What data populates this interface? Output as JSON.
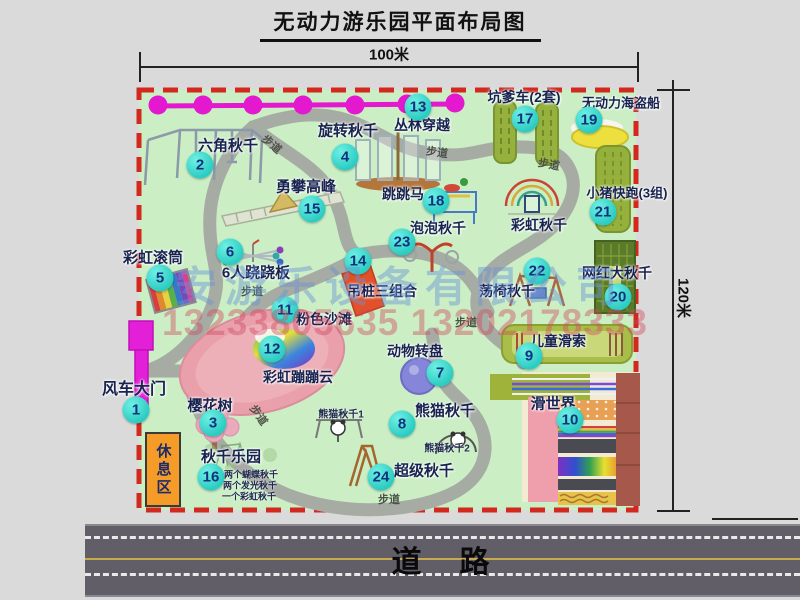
{
  "title": "无动力游乐园平面布局图",
  "dimensions": {
    "width": "100米",
    "height": "120米"
  },
  "road_label": "道　路",
  "rest_area_label": "休息区",
  "watermark": {
    "company": "安游乐设备有限公司",
    "phones": "13233805635 13202178333"
  },
  "colors": {
    "map_bg": "#cbeec5",
    "border_red": "#d3281e",
    "path_grey": "#a6aba4",
    "badge_cyan": "#2cccc2",
    "zipline_magenta": "#e318cf",
    "gate_magenta": "#e31fd8",
    "rest_orange": "#f59c28",
    "beach_pink": "#e9a0ab",
    "road_grey": "#615e68"
  },
  "attractions": [
    {
      "id": "windmill-gate",
      "num": "1",
      "label": "风车大门",
      "lx": 134,
      "ly": 387,
      "fs": 16,
      "bx": 136,
      "by": 410
    },
    {
      "id": "hexagon-swing",
      "num": "2",
      "label": "六角秋千",
      "lx": 228,
      "ly": 145,
      "fs": 15,
      "bx": 200,
      "by": 165
    },
    {
      "id": "cherry-tree",
      "num": "3",
      "label": "樱花树",
      "lx": 210,
      "ly": 405,
      "fs": 15,
      "bx": 213,
      "by": 423
    },
    {
      "id": "rotating-swing",
      "num": "4",
      "label": "旋转秋千",
      "lx": 348,
      "ly": 130,
      "fs": 15,
      "bx": 345,
      "by": 157
    },
    {
      "id": "rainbow-roller",
      "num": "5",
      "label": "彩虹滚筒",
      "lx": 153,
      "ly": 257,
      "fs": 15,
      "bx": 160,
      "by": 278
    },
    {
      "id": "six-seesaw",
      "num": "6",
      "label": "6人跷跷板",
      "lx": 256,
      "ly": 272,
      "fs": 15,
      "bx": 230,
      "by": 252
    },
    {
      "id": "animal-turntable",
      "num": "7",
      "label": "动物转盘",
      "lx": 415,
      "ly": 351,
      "fs": 14,
      "bx": 440,
      "by": 373
    },
    {
      "id": "panda-swing",
      "num": "8",
      "label": "熊猫秋千",
      "lx": 445,
      "ly": 410,
      "fs": 15,
      "bx": 402,
      "by": 424
    },
    {
      "id": "kids-zipline",
      "num": "9",
      "label": "儿童滑索",
      "lx": 558,
      "ly": 341,
      "fs": 14,
      "bx": 529,
      "by": 356
    },
    {
      "id": "slide-world",
      "num": "10",
      "label": "滑世界",
      "lx": 553,
      "ly": 403,
      "fs": 15,
      "bx": 570,
      "by": 420
    },
    {
      "id": "pink-beach",
      "num": "11",
      "label": "粉色沙滩",
      "lx": 324,
      "ly": 319,
      "fs": 14,
      "bx": 285,
      "by": 310
    },
    {
      "id": "rainbow-cloud",
      "num": "12",
      "label": "彩虹蹦蹦云",
      "lx": 298,
      "ly": 377,
      "fs": 14,
      "bx": 272,
      "by": 349
    },
    {
      "id": "jungle-crossing",
      "num": "13",
      "label": "丛林穿越",
      "lx": 422,
      "ly": 125,
      "fs": 14,
      "bx": 418,
      "by": 107
    },
    {
      "id": "hanging-pile",
      "num": "14",
      "label": "吊桩三组合",
      "lx": 382,
      "ly": 291,
      "fs": 14,
      "bx": 358,
      "by": 261
    },
    {
      "id": "climbing-peak",
      "num": "15",
      "label": "勇攀高峰",
      "lx": 306,
      "ly": 186,
      "fs": 15,
      "bx": 312,
      "by": 209
    },
    {
      "id": "swing-paradise",
      "num": "16",
      "label": "秋千乐园",
      "lx": 231,
      "ly": 456,
      "fs": 15,
      "bx": 211,
      "by": 477
    },
    {
      "id": "pit-cart",
      "num": "17",
      "label": "坑爹车(2套)",
      "lx": 524,
      "ly": 97,
      "fs": 14,
      "bx": 525,
      "by": 119
    },
    {
      "id": "jumping-horse",
      "num": "18",
      "label": "跳跳马",
      "lx": 403,
      "ly": 194,
      "fs": 14,
      "bx": 436,
      "by": 201
    },
    {
      "id": "pirate-ship",
      "num": "19",
      "label": "无动力海盗船",
      "lx": 621,
      "ly": 102,
      "fs": 13,
      "bx": 589,
      "by": 120
    },
    {
      "id": "big-net-swing",
      "num": "20",
      "label": "网红大秋千",
      "lx": 617,
      "ly": 273,
      "fs": 14,
      "bx": 618,
      "by": 297
    },
    {
      "id": "piggy-run",
      "num": "21",
      "label": "小猪快跑(3组)",
      "lx": 627,
      "ly": 192,
      "fs": 13,
      "bx": 603,
      "by": 212
    },
    {
      "id": "swing-chair",
      "num": "22",
      "label": "荡椅秋千",
      "lx": 507,
      "ly": 291,
      "fs": 14,
      "bx": 537,
      "by": 271
    },
    {
      "id": "bubble-swing",
      "num": "23",
      "label": "泡泡秋千",
      "lx": 438,
      "ly": 228,
      "fs": 14,
      "bx": 402,
      "by": 242
    },
    {
      "id": "super-swing",
      "num": "24",
      "label": "超级秋千",
      "lx": 424,
      "ly": 470,
      "fs": 15,
      "bx": 381,
      "by": 477
    },
    {
      "id": "rainbow-swing",
      "num": null,
      "label": "彩虹秋千",
      "lx": 539,
      "ly": 225,
      "fs": 14,
      "bx": null,
      "by": null
    }
  ],
  "path_labels": [
    {
      "text": "步道",
      "x": 272,
      "y": 144,
      "rot": 40
    },
    {
      "text": "步道",
      "x": 437,
      "y": 152,
      "rot": 8
    },
    {
      "text": "步道",
      "x": 549,
      "y": 164,
      "rot": 10
    },
    {
      "text": "步道",
      "x": 252,
      "y": 291,
      "rot": 0
    },
    {
      "text": "步道",
      "x": 466,
      "y": 322,
      "rot": 0
    },
    {
      "text": "步道",
      "x": 389,
      "y": 499,
      "rot": 0
    },
    {
      "text": "步道",
      "x": 259,
      "y": 415,
      "rot": 55
    }
  ],
  "notes": [
    {
      "text": "熊猫秋千1",
      "x": 341,
      "y": 413,
      "fs": 10
    },
    {
      "text": "熊猫秋千2",
      "x": 447,
      "y": 447,
      "fs": 10
    },
    {
      "text": "两个蝴蝶秋千",
      "x": 251,
      "y": 474,
      "fs": 9
    },
    {
      "text": "两个发光秋千",
      "x": 250,
      "y": 485,
      "fs": 9
    },
    {
      "text": "一个彩虹秋千",
      "x": 249,
      "y": 496,
      "fs": 9
    }
  ]
}
